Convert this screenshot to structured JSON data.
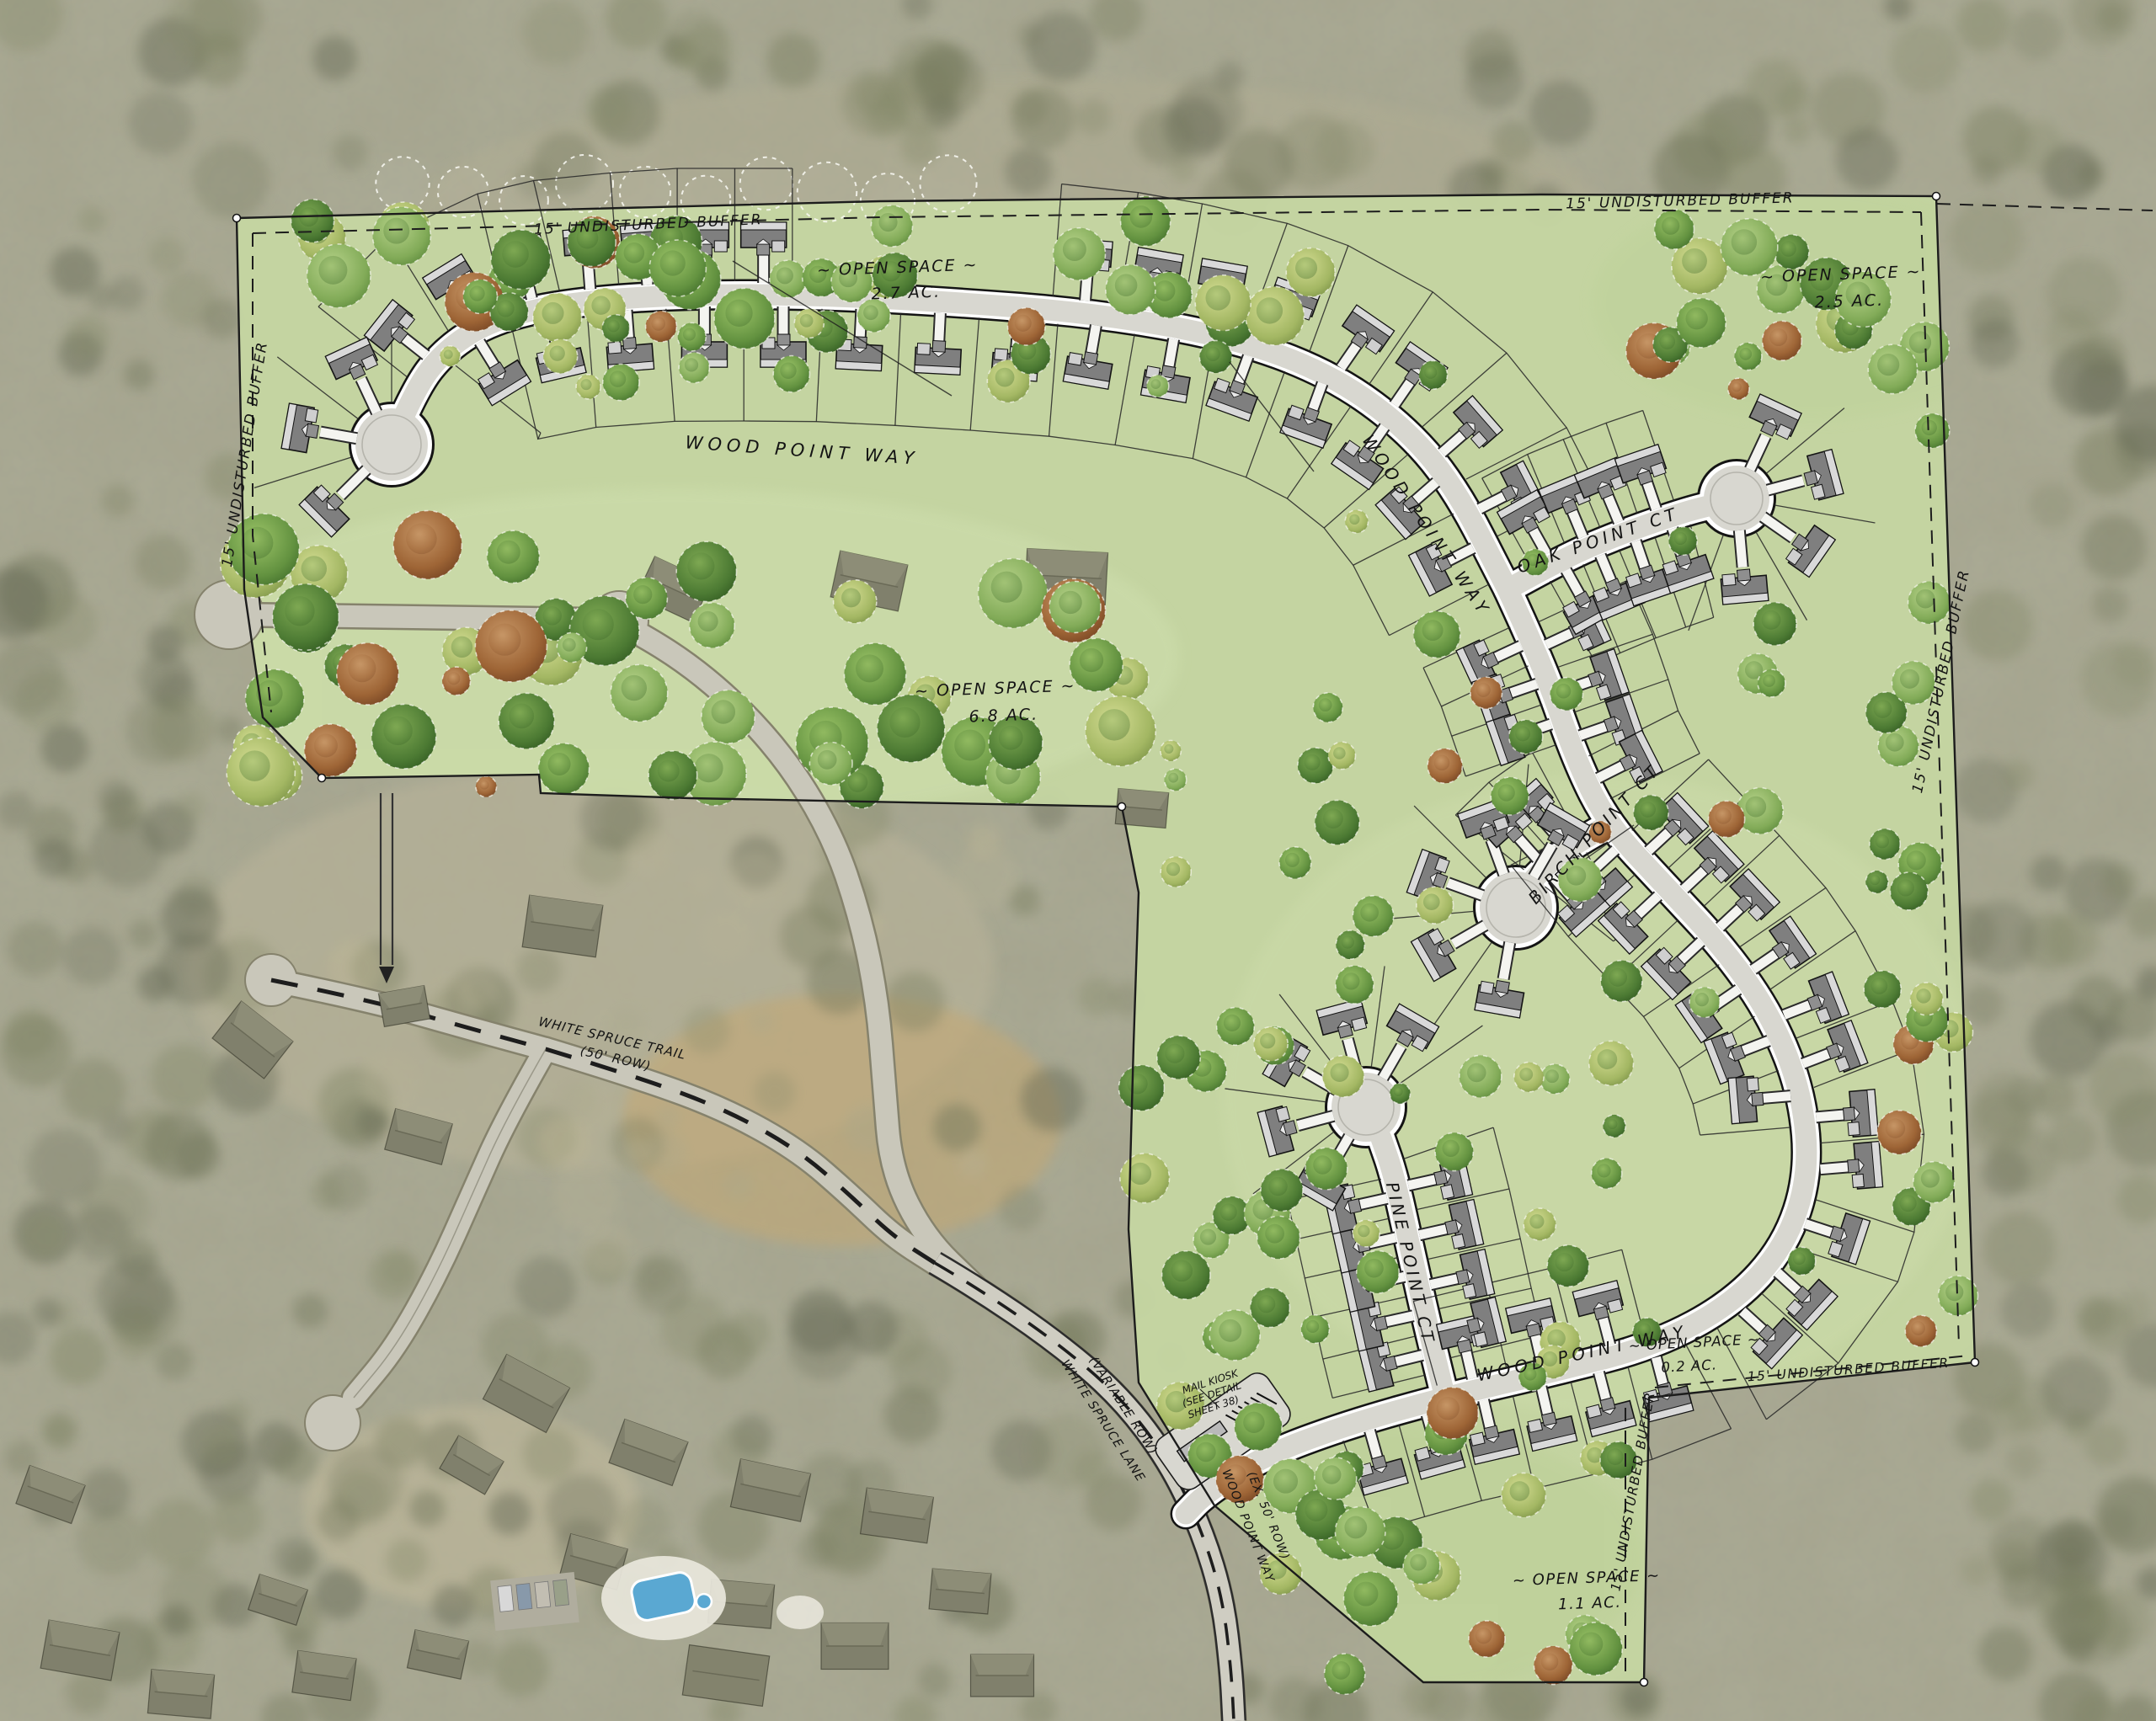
{
  "plan": {
    "type": "residential subdivision rendered site plan over aerial photo"
  },
  "streets": {
    "main": "WOOD POINT WAY",
    "oak": "OAK POINT CT",
    "birch": "BIRCH POINT CT",
    "pine": "PINE POINT CT",
    "trail": "WHITE SPRUCE TRAIL",
    "trail_row": "(50' ROW)",
    "lane": "WHITE SPRUCE LANE",
    "lane_row": "(VARIABLE ROW)",
    "entry": "WOOD POINT WAY",
    "entry_row": "(EX. 50' ROW)"
  },
  "open_spaces": [
    {
      "label": "~ OPEN SPACE ~",
      "acreage": "2.7 AC."
    },
    {
      "label": "~ OPEN SPACE ~",
      "acreage": "2.5 AC."
    },
    {
      "label": "~ OPEN SPACE ~",
      "acreage": "6.8 AC."
    },
    {
      "label": "~ OPEN SPACE ~",
      "acreage": "0.2 AC."
    },
    {
      "label": "~ OPEN SPACE ~",
      "acreage": "1.1 AC."
    }
  ],
  "buffer_label": "15' UNDISTURBED BUFFER",
  "mail_kiosk": {
    "line1": "MAIL KIOSK",
    "line2": "(SEE DETAIL",
    "line3": "SHEET 38)"
  },
  "colors": {
    "aerial_base": "#a6a58f",
    "site_green": "#c6d7a2",
    "road_gray": "#d8d7d0",
    "existing_road": "#c9c7ba",
    "tree_green": "#6f9c49",
    "tree_red": "#9c6434",
    "pool_blue": "#5aa8d2",
    "line_black": "#1c1c1c"
  }
}
